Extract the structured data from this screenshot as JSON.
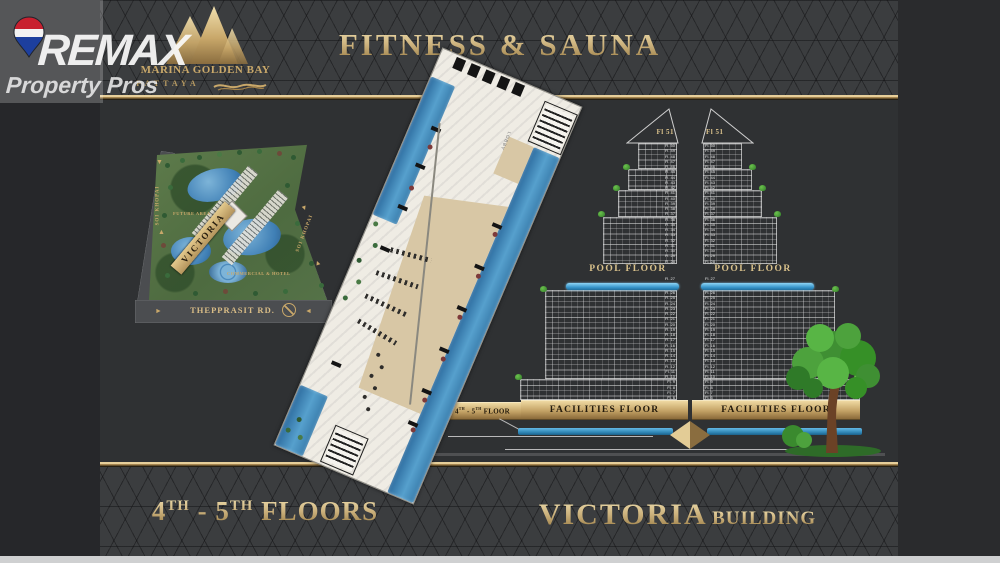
{
  "watermark": {
    "brand": "REMAX",
    "tagline": "Property Pros"
  },
  "logo": {
    "name": "MARINA GOLDEN BAY",
    "city": "PATTAYA"
  },
  "header": {
    "title": "FITNESS & SAUNA"
  },
  "site_plan": {
    "building": "VICTORIA",
    "road_bottom": "THEPPRASIT RD.",
    "road_left": "SOI KHOPAI",
    "road_right": "SOI KHOPAI",
    "future_area": "FUTURE AREA",
    "commercial": "COMMERCIAL & HOTEL"
  },
  "floor_plan": {
    "lobby": "LOBBY"
  },
  "elevation": {
    "roof_label": "Fl 51",
    "pool_floor": "POOL FLOOR",
    "facilities_floor": "FACILITIES FLOOR",
    "pool": "POOL",
    "callout": {
      "num1": "4",
      "sup1": "TH",
      "mid": " - 5",
      "sup2": "TH",
      "word": " FLOOR"
    },
    "floors_upper": [
      "Fl. 50",
      "Fl. 49",
      "Fl. 48",
      "Fl. 47",
      "Fl. 46",
      "Fl. 45",
      "Fl. 44",
      "Fl. 43",
      "Fl. 42",
      "Fl. 41",
      "Fl. 40",
      "Fl. 39",
      "Fl. 38",
      "Fl. 37",
      "Fl. 36",
      "Fl. 35",
      "Fl. 34",
      "Fl. 33",
      "Fl. 32",
      "Fl. 31",
      "Fl. 30",
      "Fl. 29",
      "Fl. 28"
    ],
    "floor_pool": "Fl. 27",
    "floors_lower": [
      "Fl. 26",
      "Fl. 25",
      "Fl. 24",
      "Fl. 23",
      "Fl. 22",
      "Fl. 21",
      "Fl. 20",
      "Fl. 19",
      "Fl. 18",
      "Fl. 17",
      "Fl. 16",
      "Fl. 15",
      "Fl. 14",
      "Fl. 13",
      "Fl. 12",
      "Fl. 11",
      "Fl. 10",
      "Fl. 9",
      "Fl. 8",
      "Fl. 7",
      "Fl. 6"
    ]
  },
  "footer": {
    "left": {
      "num1": "4",
      "sup1": "TH",
      "mid": " - 5",
      "sup2": "TH",
      "word": " FLOORS"
    },
    "right": {
      "name": "VICTORIA",
      "type": "BUILDING"
    }
  },
  "colors": {
    "gold": "#c9a86a",
    "gold_light": "#ecd9a6",
    "gold_dark": "#8a6d3f",
    "pool_blue": "#55b0e0",
    "plan_blue": "#3f7fb5",
    "tree_green": "#3f8f33"
  }
}
